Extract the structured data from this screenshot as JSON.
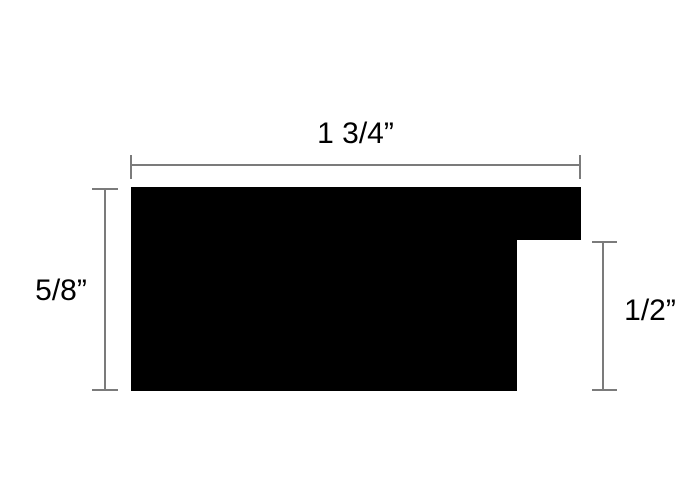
{
  "diagram": {
    "type": "dimensioned-profile-cross-section",
    "shape": {
      "description": "solid black L-shaped moulding profile with rabbet notch at lower right",
      "fill": "#000000"
    },
    "dimensions": [
      {
        "id": "width",
        "label": "1 3/4”",
        "orientation": "horizontal",
        "position": "top"
      },
      {
        "id": "left_height",
        "label": "5/8”",
        "orientation": "vertical",
        "position": "left"
      },
      {
        "id": "right_height",
        "label": "1/2”",
        "orientation": "vertical",
        "position": "right"
      }
    ],
    "colors": {
      "shape": "#000000",
      "dimension_line": "#7b7b7b",
      "text": "#000000",
      "background": "#ffffff"
    }
  }
}
